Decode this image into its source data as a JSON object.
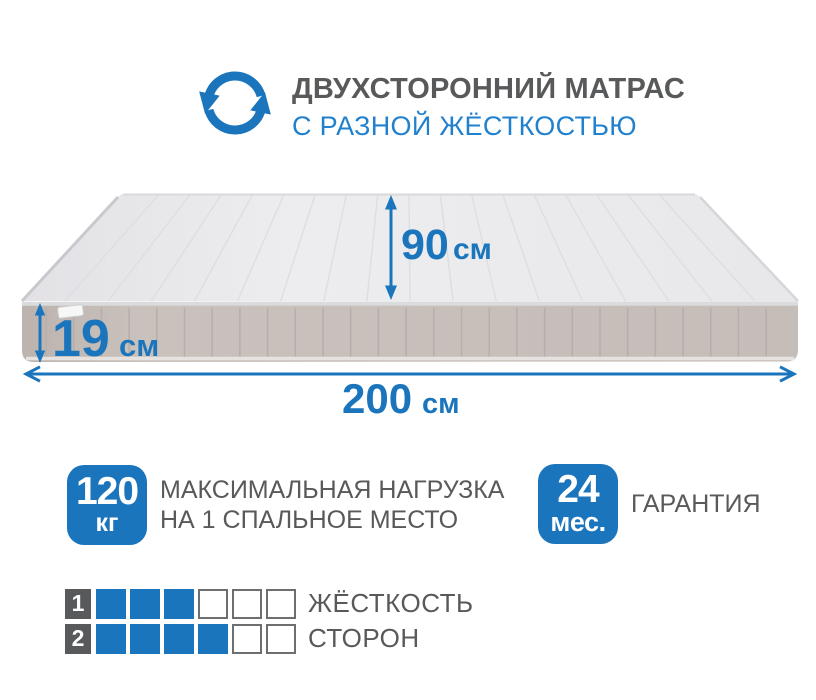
{
  "header": {
    "title": "ДВУХСТОРОННИЙ МАТРАС",
    "subtitle": "С РАЗНОЙ ЖЁСТКОСТЬЮ",
    "icon": "rotate-arrows-icon"
  },
  "dimensions": {
    "depth": {
      "value": "90",
      "unit": "см"
    },
    "height": {
      "value": "19",
      "unit": "см"
    },
    "length": {
      "value": "200",
      "unit": "см"
    }
  },
  "badges": [
    {
      "name": "max-load",
      "value": "120",
      "unit": "кг",
      "caption_line1": "МАКСИМАЛЬНАЯ НАГРУЗКА",
      "caption_line2": "НА 1 СПАЛЬНОЕ МЕСТО"
    },
    {
      "name": "warranty",
      "value": "24",
      "unit": "мес.",
      "caption_line1": "ГАРАНТИЯ"
    }
  ],
  "firmness": {
    "labels": [
      "ЖЁСТКОСТЬ",
      "СТОРОН"
    ],
    "scale_max": 6,
    "sides": [
      {
        "number": "1",
        "filled": 3
      },
      {
        "number": "2",
        "filled": 4
      }
    ]
  },
  "colors": {
    "accent_blue": "#1b75bc",
    "subtitle_blue": "#2181ce",
    "text_gray": "#58595b",
    "mattress_top": "#e9e9eb",
    "mattress_side": "#c6beb9",
    "number_box_gray": "#58595b",
    "empty_square_border": "#6d6e70"
  }
}
